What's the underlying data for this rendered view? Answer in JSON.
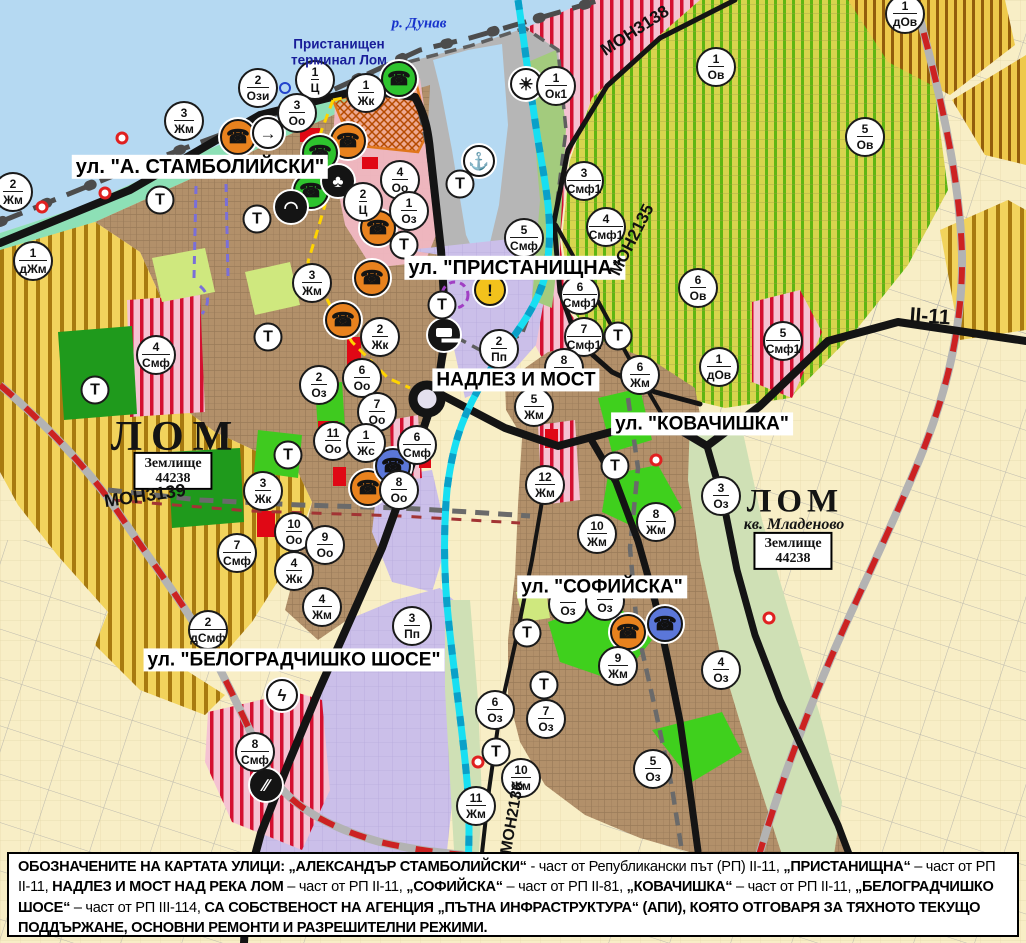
{
  "map": {
    "t_label": "Т",
    "street_labels": [
      {
        "text": "ул. \"А. СТАМБОЛИЙСКИ\"",
        "x": 200,
        "y": 167,
        "fs": 20
      },
      {
        "text": "ул. \"ПРИСТАНИЩНА\"",
        "x": 515,
        "y": 268,
        "fs": 20
      },
      {
        "text": "НАДЛЕЗ И МОСТ",
        "x": 516,
        "y": 380,
        "fs": 19
      },
      {
        "text": "ул. \"КОВАЧИШКА\"",
        "x": 702,
        "y": 424,
        "fs": 19
      },
      {
        "text": "ул. \"СОФИЙСКА\"",
        "x": 602,
        "y": 587,
        "fs": 19
      },
      {
        "text": "ул. \"БЕЛОГРАДЧИШКО ШОСЕ\"",
        "x": 294,
        "y": 660,
        "fs": 19
      }
    ],
    "place_labels": [
      {
        "text": "р. Дунав",
        "x": 419,
        "y": 24,
        "cls": "lbl-river",
        "name": "danube-river-label"
      },
      {
        "text": "Пристанищен\nтерминал Лом",
        "x": 339,
        "y": 52,
        "cls": "lbl-port",
        "name": "port-terminal-label"
      },
      {
        "text": "ЛОМ",
        "x": 176,
        "y": 437,
        "cls": "lbl-city",
        "name": "city-label-lom"
      },
      {
        "text": "ЛОМ",
        "x": 795,
        "y": 502,
        "cls": "lbl-city2",
        "name": "city-label-lom-mladenovo"
      },
      {
        "text": "кв. Младеново",
        "x": 794,
        "y": 525,
        "cls": "lbl-quarter",
        "name": "quarter-label-mladenovo"
      }
    ],
    "landplot_boxes": [
      {
        "line1": "Землище",
        "line2": "44238",
        "x": 173,
        "y": 471
      },
      {
        "line1": "Землище",
        "line2": "44238",
        "x": 793,
        "y": 551
      }
    ],
    "road_labels": [
      {
        "text": "МОН3139",
        "x": 145,
        "y": 496,
        "rot": -8,
        "fs": 18
      },
      {
        "text": "МОН3138",
        "x": 635,
        "y": 31,
        "rot": -33,
        "fs": 17
      },
      {
        "text": "МОН2135",
        "x": 632,
        "y": 240,
        "rot": -63,
        "fs": 17
      },
      {
        "text": "МОН2136",
        "x": 513,
        "y": 818,
        "rot": -80,
        "fs": 16
      },
      {
        "text": "II-11",
        "x": 930,
        "y": 317,
        "rot": 4,
        "fs": 21
      }
    ],
    "zone_markers": [
      {
        "n": "2",
        "c": "Жм",
        "x": 13,
        "y": 192
      },
      {
        "n": "1",
        "c": "дЖм",
        "x": 33,
        "y": 261
      },
      {
        "n": "3",
        "c": "Жм",
        "x": 184,
        "y": 121
      },
      {
        "n": "2",
        "c": "Ози",
        "x": 258,
        "y": 88
      },
      {
        "n": "1",
        "c": "Ц",
        "x": 315,
        "y": 80
      },
      {
        "n": "3",
        "c": "Оо",
        "x": 297,
        "y": 113
      },
      {
        "n": "1",
        "c": "Жк",
        "x": 366,
        "y": 93
      },
      {
        "n": "4",
        "c": "Оо",
        "x": 400,
        "y": 180
      },
      {
        "n": "2",
        "c": "Ц",
        "x": 363,
        "y": 202
      },
      {
        "n": "1",
        "c": "Оз",
        "x": 409,
        "y": 211
      },
      {
        "n": "3",
        "c": "Жм",
        "x": 312,
        "y": 283
      },
      {
        "n": "2",
        "c": "Жк",
        "x": 380,
        "y": 337
      },
      {
        "n": "4",
        "c": "Смф",
        "x": 156,
        "y": 355
      },
      {
        "n": "2",
        "c": "Оз",
        "x": 319,
        "y": 385
      },
      {
        "n": "6",
        "c": "Оо",
        "x": 362,
        "y": 378
      },
      {
        "n": "7",
        "c": "Оо",
        "x": 377,
        "y": 412
      },
      {
        "n": "11",
        "c": "Оо",
        "x": 333,
        "y": 441
      },
      {
        "n": "1",
        "c": "Жс",
        "x": 366,
        "y": 443
      },
      {
        "n": "6",
        "c": "Смф",
        "x": 417,
        "y": 445
      },
      {
        "n": "8",
        "c": "Оо",
        "x": 399,
        "y": 490
      },
      {
        "n": "3",
        "c": "Жк",
        "x": 263,
        "y": 491
      },
      {
        "n": "10",
        "c": "Оо",
        "x": 294,
        "y": 532
      },
      {
        "n": "9",
        "c": "Оо",
        "x": 325,
        "y": 545
      },
      {
        "n": "4",
        "c": "Жк",
        "x": 294,
        "y": 571
      },
      {
        "n": "7",
        "c": "Смф",
        "x": 237,
        "y": 553
      },
      {
        "n": "4",
        "c": "Жм",
        "x": 322,
        "y": 607
      },
      {
        "n": "2",
        "c": "дСмф",
        "x": 208,
        "y": 630
      },
      {
        "n": "3",
        "c": "Пп",
        "x": 412,
        "y": 626
      },
      {
        "n": "8",
        "c": "Смф",
        "x": 255,
        "y": 752
      },
      {
        "n": "1",
        "c": "Ок1",
        "x": 556,
        "y": 86
      },
      {
        "n": "3",
        "c": "Смф1",
        "x": 584,
        "y": 181
      },
      {
        "n": "4",
        "c": "Смф1",
        "x": 606,
        "y": 227
      },
      {
        "n": "5",
        "c": "Смф",
        "x": 524,
        "y": 238
      },
      {
        "n": "6",
        "c": "Смф1",
        "x": 580,
        "y": 295
      },
      {
        "n": "7",
        "c": "Смф1",
        "x": 584,
        "y": 337
      },
      {
        "n": "2",
        "c": "Пп",
        "x": 499,
        "y": 349
      },
      {
        "n": "8",
        "c": "Жм",
        "x": 564,
        "y": 368
      },
      {
        "n": "5",
        "c": "Жм",
        "x": 534,
        "y": 407
      },
      {
        "n": "12",
        "c": "Жм",
        "x": 545,
        "y": 485
      },
      {
        "n": "1",
        "c": "Ов",
        "x": 716,
        "y": 67
      },
      {
        "n": "1",
        "c": "дОв",
        "x": 905,
        "y": 14
      },
      {
        "n": "5",
        "c": "Ов",
        "x": 865,
        "y": 137
      },
      {
        "n": "6",
        "c": "Ов",
        "x": 698,
        "y": 288
      },
      {
        "n": "1",
        "c": "дОв",
        "x": 719,
        "y": 367
      },
      {
        "n": "5",
        "c": "Смф1",
        "x": 783,
        "y": 341
      },
      {
        "n": "6",
        "c": "Жм",
        "x": 640,
        "y": 375
      },
      {
        "n": "8",
        "c": "Жм",
        "x": 656,
        "y": 522
      },
      {
        "n": "3",
        "c": "Оз",
        "x": 721,
        "y": 496
      },
      {
        "n": "10",
        "c": "Жм",
        "x": 597,
        "y": 534
      },
      {
        "n": "9",
        "c": "Жм",
        "x": 618,
        "y": 666
      },
      {
        "n": "4",
        "c": "Оз",
        "x": 721,
        "y": 670
      },
      {
        "n": "",
        "c": "Оз",
        "x": 568,
        "y": 604
      },
      {
        "n": "",
        "c": "Оз",
        "x": 605,
        "y": 601
      },
      {
        "n": "6",
        "c": "Оз",
        "x": 495,
        "y": 710
      },
      {
        "n": "7",
        "c": "Оз",
        "x": 546,
        "y": 719
      },
      {
        "n": "10",
        "c": "Жм",
        "x": 521,
        "y": 778
      },
      {
        "n": "11",
        "c": "Жм",
        "x": 476,
        "y": 806
      },
      {
        "n": "5",
        "c": "Оз",
        "x": 653,
        "y": 769
      }
    ],
    "t_markers": [
      [
        160,
        200
      ],
      [
        257,
        219
      ],
      [
        404,
        245
      ],
      [
        460,
        184
      ],
      [
        268,
        337
      ],
      [
        95,
        390
      ],
      [
        288,
        455
      ],
      [
        442,
        305
      ],
      [
        618,
        336
      ],
      [
        615,
        466
      ],
      [
        527,
        633
      ],
      [
        544,
        685
      ],
      [
        496,
        752
      ]
    ],
    "icon_markers": [
      {
        "icon": "phone",
        "color": "orange",
        "x": 238,
        "y": 137
      },
      {
        "icon": "phone",
        "color": "orange",
        "x": 348,
        "y": 141
      },
      {
        "icon": "phone",
        "color": "orange",
        "x": 378,
        "y": 228
      },
      {
        "icon": "phone",
        "color": "orange",
        "x": 372,
        "y": 278
      },
      {
        "icon": "phone",
        "color": "orange",
        "x": 343,
        "y": 320
      },
      {
        "icon": "phone",
        "color": "orange",
        "x": 368,
        "y": 488
      },
      {
        "icon": "phone",
        "color": "orange",
        "x": 628,
        "y": 632
      },
      {
        "icon": "phone",
        "color": "green",
        "x": 399,
        "y": 79
      },
      {
        "icon": "phone",
        "color": "green",
        "x": 320,
        "y": 153
      },
      {
        "icon": "phone",
        "color": "green",
        "x": 311,
        "y": 191
      },
      {
        "icon": "phone",
        "color": "blue",
        "x": 393,
        "y": 466
      },
      {
        "icon": "phone",
        "color": "blue",
        "x": 665,
        "y": 624
      },
      {
        "icon": "club",
        "color": "black",
        "x": 338,
        "y": 181
      },
      {
        "icon": "arrow",
        "color": "white",
        "x": 268,
        "y": 133
      },
      {
        "icon": "tunnel",
        "color": "black",
        "x": 291,
        "y": 207
      },
      {
        "icon": "anchor",
        "color": "white",
        "x": 479,
        "y": 161
      },
      {
        "icon": "sun",
        "color": "white",
        "x": 526,
        "y": 84
      },
      {
        "icon": "truck",
        "color": "black",
        "x": 444,
        "y": 335
      },
      {
        "icon": "warning",
        "color": "yellow",
        "x": 490,
        "y": 290
      },
      {
        "icon": "lightning",
        "color": "white",
        "x": 282,
        "y": 695
      },
      {
        "icon": "railcross",
        "color": "black",
        "x": 266,
        "y": 785
      }
    ],
    "poi_dots": [
      [
        122,
        138
      ],
      [
        105,
        193
      ],
      [
        42,
        207
      ],
      [
        656,
        460
      ],
      [
        769,
        618
      ],
      [
        478,
        762
      ]
    ],
    "ring_dots": [
      [
        285,
        88
      ]
    ],
    "colors": {
      "water": "#b5d9f2",
      "shore": "#8de0b6",
      "port": "#b6b6b6",
      "urban": "#b2906a",
      "farmland": "#f8eec6",
      "vineyard_striped": "#d8d44e",
      "residential_striped": "#f2d35c",
      "mixed_striped_pink": "#f5c2d2",
      "industrial_lavender": "#cbbfe9",
      "green_area": "#3fca1f",
      "river": "#18dff2",
      "road": "#141414",
      "railway_red": "#cc2222",
      "accent_orange": "#e0761a",
      "route_yellow": "#ffd400"
    }
  },
  "legend": {
    "segments": [
      {
        "t": "ОБОЗНАЧЕНИТЕ НА КАРТАТА УЛИЦИ: „АЛЕКСАНДЪР СТАМБОЛИЙСКИ“",
        "b": true
      },
      {
        "t": " - част от Републикански път (РП) II-11, ",
        "b": false
      },
      {
        "t": "„ПРИСТАНИЩНА“",
        "b": true
      },
      {
        "t": " – част от РП II-11, ",
        "b": false
      },
      {
        "t": "НАДЛЕЗ И МОСТ НАД РЕКА ЛОМ",
        "b": true
      },
      {
        "t": " – част от РП II-11, ",
        "b": false
      },
      {
        "t": "„СОФИЙСКА“",
        "b": true
      },
      {
        "t": " – част от РП II-81, ",
        "b": false
      },
      {
        "t": "„КОВАЧИШКА“",
        "b": true
      },
      {
        "t": " – част от РП II-11, ",
        "b": false
      },
      {
        "t": "„БЕЛОГРАДЧИШКО ШОСЕ“",
        "b": true
      },
      {
        "t": " – част от РП III-114, ",
        "b": false
      },
      {
        "t": "СА СОБСТВЕНОСТ НА АГЕНЦИЯ „ПЪТНА ИНФРАСТРУКТУРА“ (АПИ), КОЯТО ОТГОВАРЯ ЗА ТЯХНОТО ТЕКУЩО ПОДДЪРЖАНЕ, ОСНОВНИ РЕМОНТИ И РАЗРЕШИТЕЛНИ РЕЖИМИ.",
        "b": true
      }
    ]
  }
}
